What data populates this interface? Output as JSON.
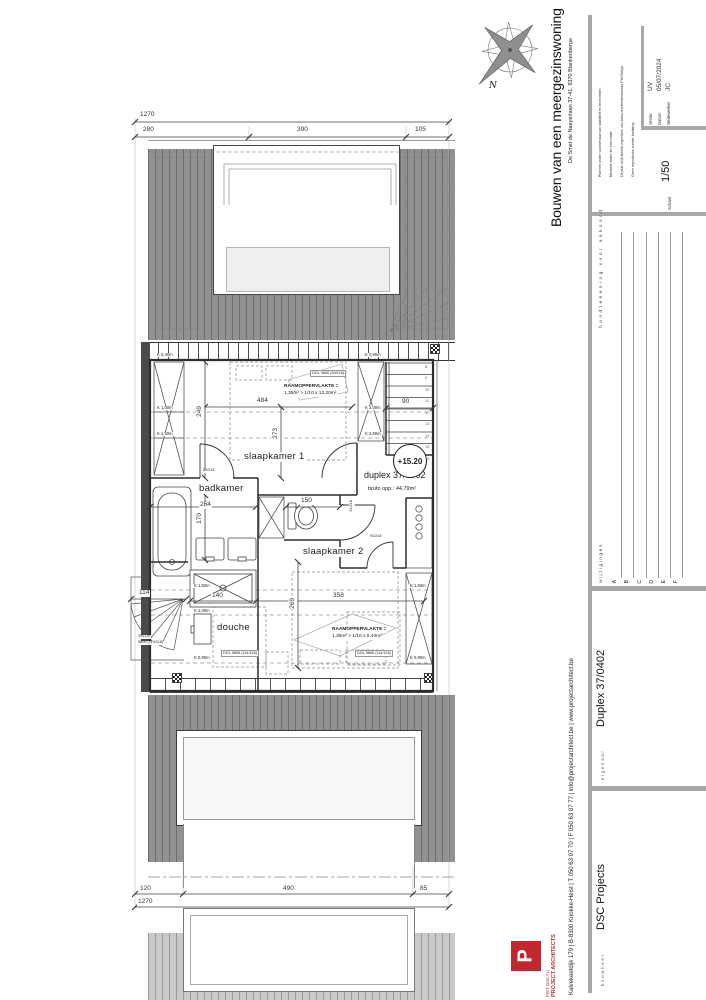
{
  "titleblock": {
    "project_title": "Bouwen van een meergezinswoning",
    "project_address": "De Smet de Naeyerlaan 37-41, 8370 Blankenberge",
    "disclaimer": [
      "Plannen onder voorbehoud van stabiliteit en technieken.",
      "Meubels louter ter informatie.",
      "Dit plan blijft steeds eigendom van bvba architectenbureau Piet Bailyu.",
      "Geen reproductie zonder toelating."
    ],
    "fields": {
      "versie_label": "Versie",
      "versie": "UV",
      "datum_label": "Datum",
      "datum": "05/07/2024",
      "medewerker_label": "Medewerker",
      "medewerker": "JC",
      "schaal_label": "Schaal",
      "schaal": "1/50"
    },
    "signature_heading": "handtekening voor akkoord",
    "changes_heading": "wijzigingen",
    "revisions": [
      "A",
      "B",
      "C",
      "D",
      "E",
      "F"
    ],
    "eigenaar_label": "eigenaar",
    "eigenaar": "Duplex 37/0402",
    "bouwheer_label": "bouwheer",
    "bouwheer": "DSC Projects",
    "firm": {
      "name": "PIET BAILYU",
      "tagline": "PROJECT ARCHITECTS",
      "logo_letter": "P",
      "contact": "Kalvekeetdijk 179   |   B-8300 Knokke-Heist   |   T 050 63 07 70   |   F 050 63 07 77   |   info@projectarchitect.be   |   www.projectarchitect.be"
    }
  },
  "compass": {
    "north_label": "N"
  },
  "plan": {
    "level": "+15.20",
    "unit": "duplex 37/0402",
    "unit_area": "bruto opp.: 44,79m²",
    "rooms": {
      "slaapkamer1": "slaapkamer 1",
      "badkamer": "badkamer",
      "slaapkamer2": "slaapkamer 2",
      "douche": "douche"
    },
    "notes": {
      "raam1_l1": "RAAMOPPERVLAKTE =",
      "raam1_l2": "1,35m² > 1/10 x 12,20m²",
      "raam2_l1": "RAAMOPPERVLAKTE =",
      "raam2_l2": "1,35m² > 1/10 x 9,40m²",
      "dgl_top": "DGL 9806 (94/118)",
      "dgl_bottom_left": "DGL 9806 (114/118)",
      "dgl_bottom_right": "DGL 9806 (114/118)",
      "velux_l1": "VELUX",
      "velux_l2": "9806 (114/118)"
    },
    "doors": {
      "d80": "80/216",
      "d91a": "91/216",
      "d91b": "91/216"
    },
    "dims": {
      "top_total": "1270",
      "top_a": "280",
      "top_b": "390",
      "top_c": "105",
      "bottom_a": "120",
      "bottom_b": "490",
      "bottom_c": "85",
      "bottom_total": "1270",
      "w484": "484",
      "h273": "273",
      "h249": "249",
      "w90": "90",
      "w264": "264",
      "h170": "170",
      "w150": "150",
      "w140": "140",
      "w358": "358",
      "h269": "269",
      "w114": "114"
    },
    "knee": {
      "k040": "K 0,40m",
      "k090": "K 0,90m",
      "k100": "K 1,00m",
      "k150": "K 1,50m",
      "k200": "K 2,00m",
      "k250": "K 2,50m"
    },
    "stair_numbers": [
      "8",
      "9",
      "10",
      "11",
      "12",
      "13",
      "14",
      "15",
      "16"
    ]
  },
  "colors": {
    "roof_gray": "#919191",
    "roof_stripe": "#6d6d6d",
    "accent_red": "#c1272d",
    "bar_gray": "#a8a8a8",
    "line_dark": "#2d2d2d"
  }
}
